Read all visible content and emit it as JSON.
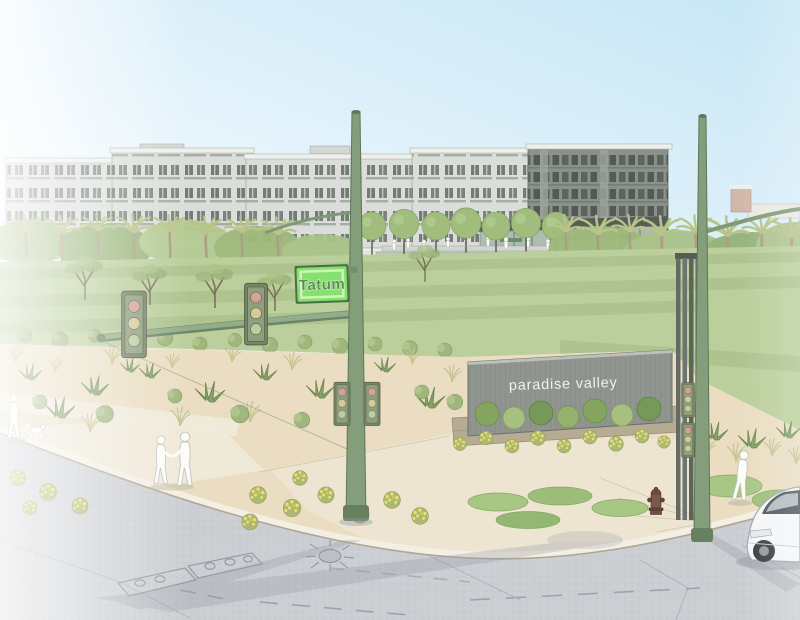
{
  "image": {
    "type": "architectural-rendering",
    "subject": "Paradise Valley mixed-use development at the Tatum street corner, watercolor style site rendering"
  },
  "signs": {
    "street_sign": {
      "label": "Tatum",
      "face_color": "#7fdf68",
      "frame_color": "#cdf5b2",
      "text_color": "#55854e"
    },
    "monument_sign": {
      "label": "paradise valley",
      "wall_color": "#8b908b",
      "text_color": "#f0f1ed"
    }
  },
  "palette": {
    "sky_left": "#ffffff",
    "sky_right": "#c3e5f5",
    "lawn_green": "#b7cd96",
    "desert_tan": "#e9dcbf",
    "road_gray": "#c9ccd0",
    "sidewalk_beige": "#efe9d8",
    "building_light": "#d9dcd7",
    "building_dark": "#848b85",
    "tree_green": "#a3bd7f",
    "palm_frond": "#b6c183",
    "pole_green": "#7e9873",
    "flower_yellow": "#e0da63",
    "car_white": "#f4f6f8",
    "hydrant_brown": "#6b4638"
  },
  "objects": [
    "apartment-buildings",
    "entrance-pavilion",
    "distant-tower",
    "palm-trees",
    "walkway-trees",
    "central-lawn",
    "desert-landscaping",
    "tatum-street-sign",
    "paradise-valley-monument-sign",
    "slat-sculpture",
    "traffic-signal-poles",
    "traffic-signal-heads",
    "yellow-flower-beds",
    "groundcover-beds",
    "fire-hydrant",
    "pedestrian-couple",
    "pedestrian-with-dog",
    "jogger",
    "white-car",
    "intersection-road",
    "curb",
    "storm-drain",
    "manhole-covers",
    "plaza-crowd"
  ]
}
